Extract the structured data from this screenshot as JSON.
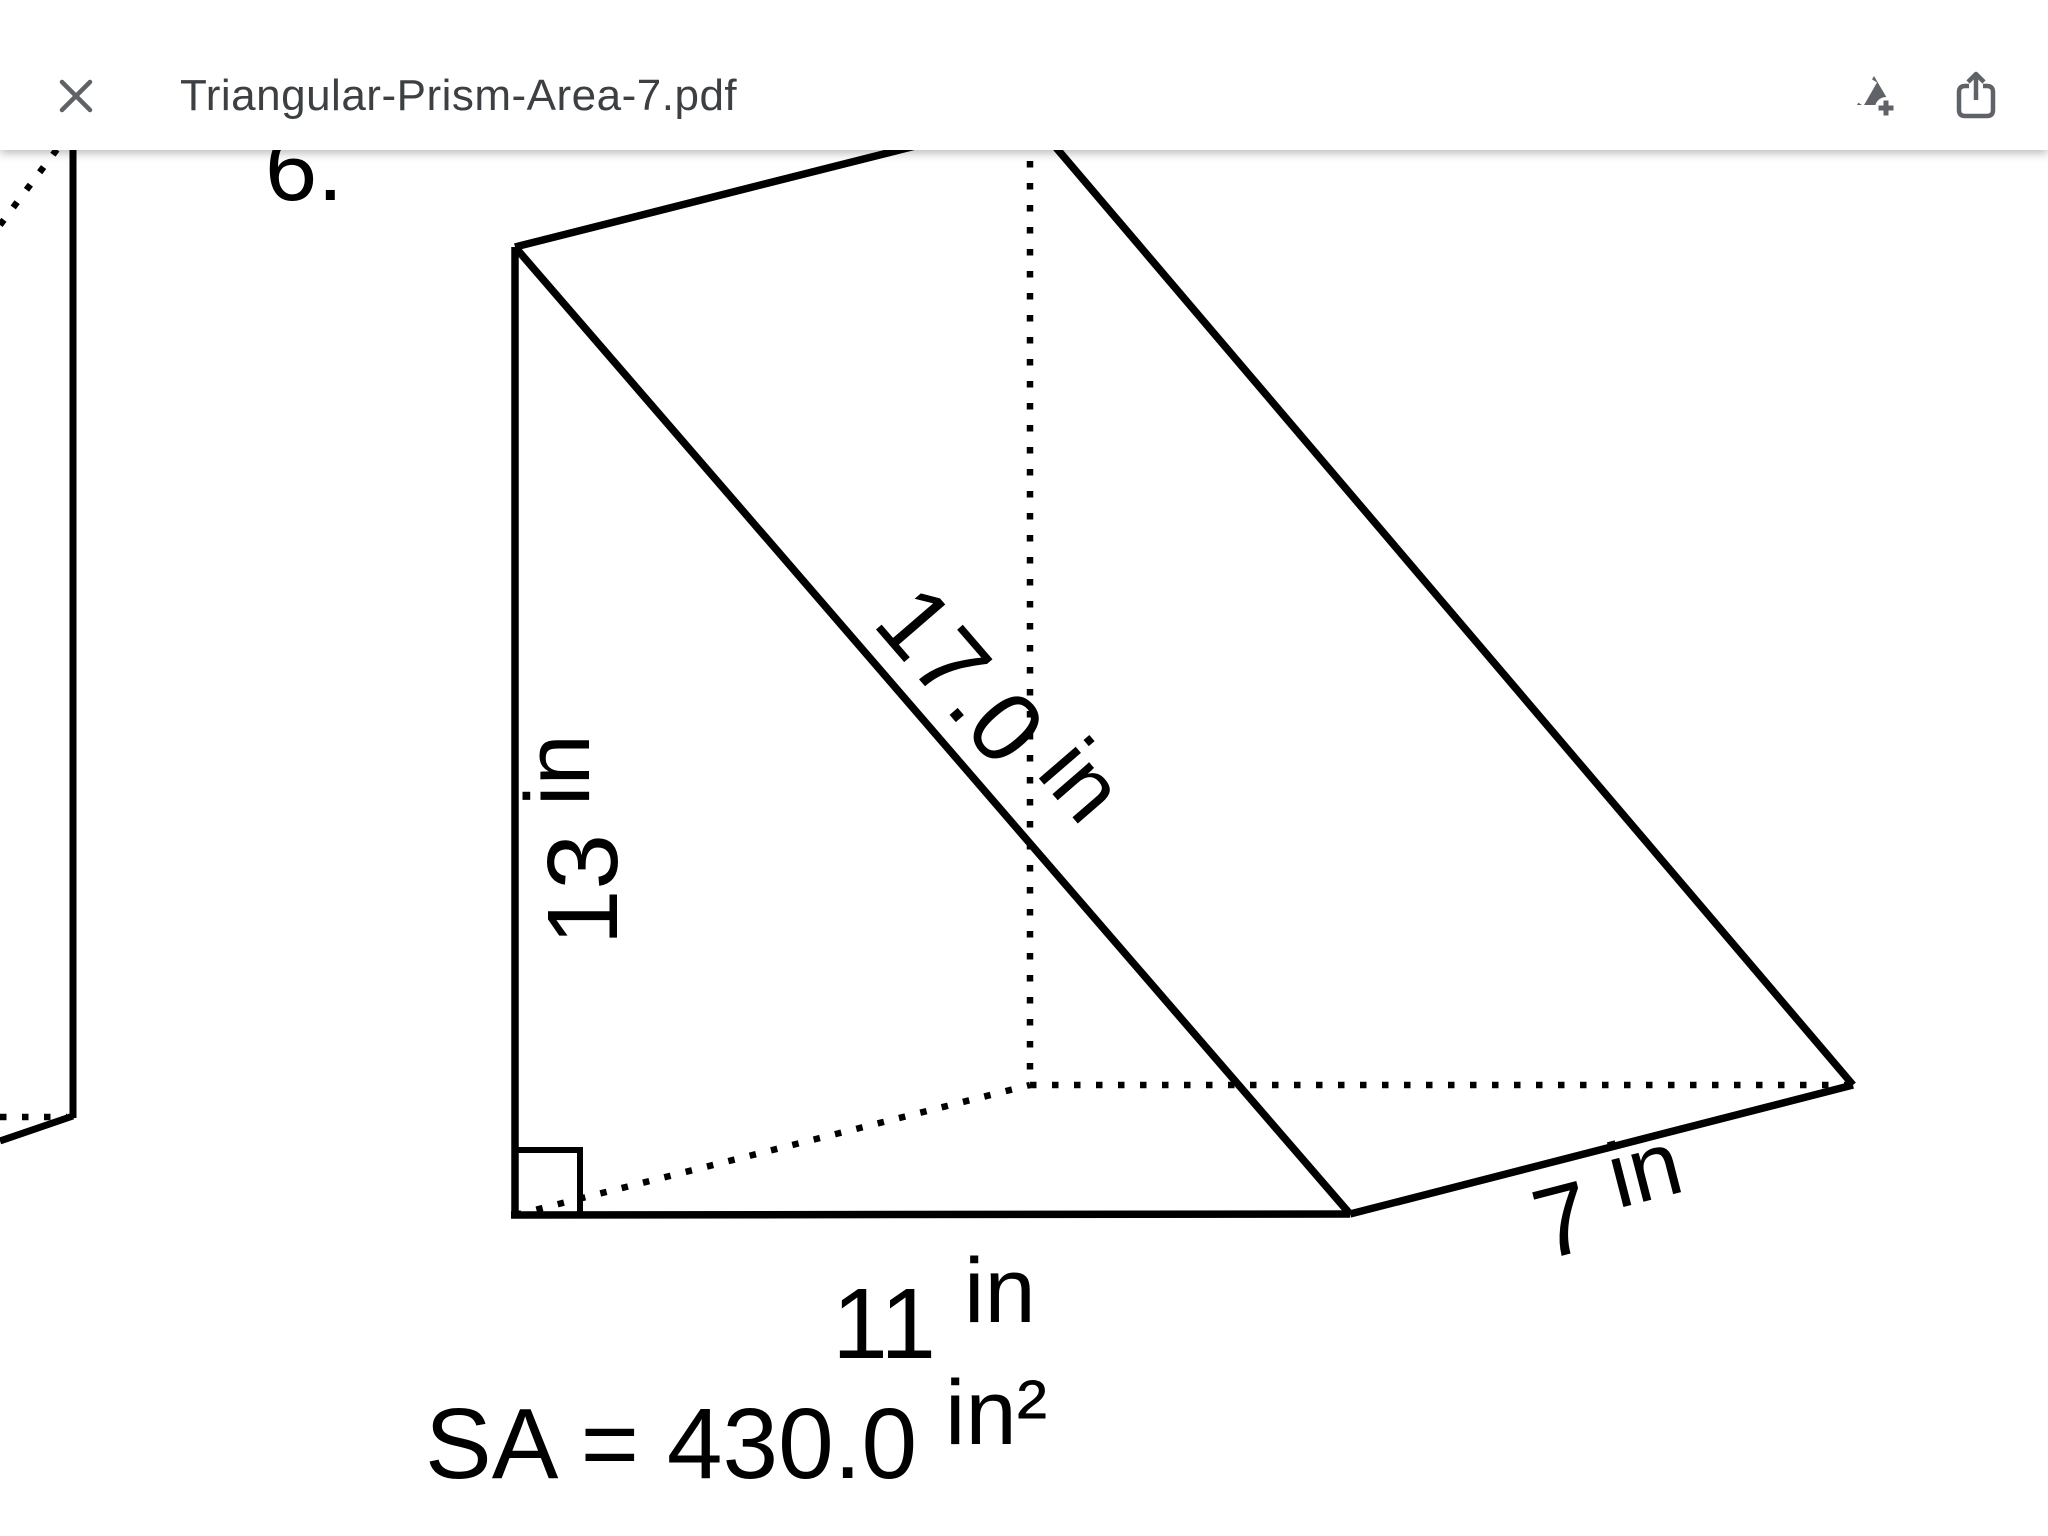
{
  "toolbar": {
    "title": "Triangular-Prism-Area-7.pdf",
    "icons": {
      "close": "close-x",
      "add_to_drive": "drive-triangle-plus",
      "share": "box-with-up-arrow"
    }
  },
  "colors": {
    "toolbar_icon": "#5f6368",
    "title_text": "#3c4043",
    "figure_line": "#000000",
    "page_background": "#ffffff"
  },
  "problem": {
    "number": "6.",
    "dimensions": {
      "height": {
        "value": "13",
        "unit": "in"
      },
      "hypotenuse": {
        "value": "17.0",
        "unit": "in"
      },
      "base": {
        "value": "11",
        "unit": "in"
      },
      "depth": {
        "value": "7",
        "unit": "in"
      }
    },
    "surface_area": {
      "label": "SA = 430.0",
      "unit": "in²"
    }
  }
}
